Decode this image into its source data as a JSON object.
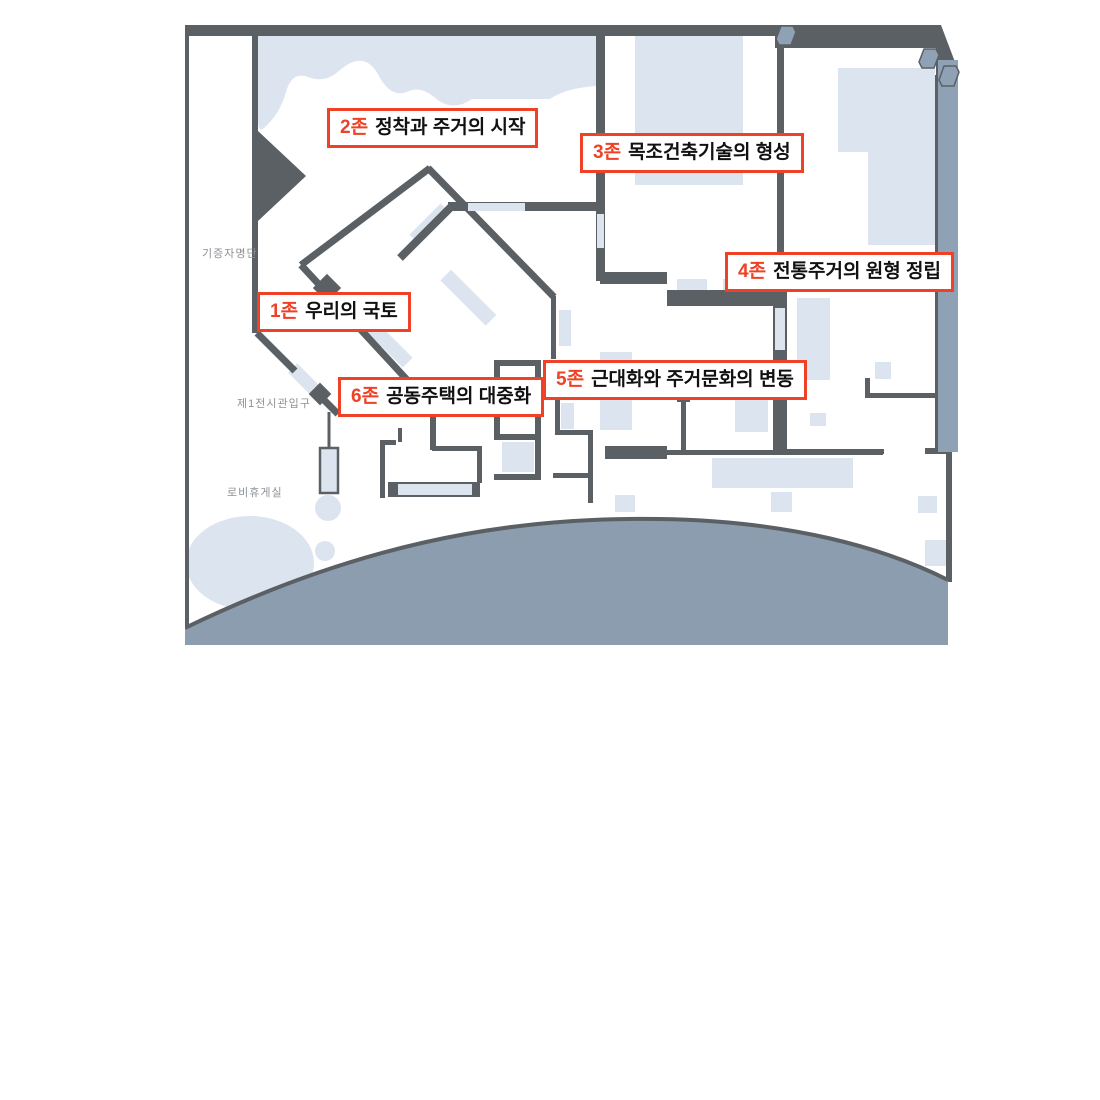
{
  "page": {
    "background": "#ffffff"
  },
  "floor_plan": {
    "area_labels": {
      "donor_list": "기증자명단",
      "hall1_entrance": "제1전시관입구",
      "lobby_lounge": "로비휴게실"
    },
    "zones": [
      {
        "num": "1존",
        "name": "우리의 국토"
      },
      {
        "num": "2존",
        "name": "정착과 주거의 시작"
      },
      {
        "num": "3존",
        "name": "목조건축기술의 형성"
      },
      {
        "num": "4존",
        "name": "전통주거의 원형 정립"
      },
      {
        "num": "5존",
        "name": "근대화와 주거문화의 변동"
      },
      {
        "num": "6존",
        "name": "공동주택의 대중화"
      }
    ],
    "colors": {
      "page_bg": "#ffffff",
      "wall": "#5B6065",
      "tint": "#DCE4EF",
      "dome": "#8C9DAF",
      "band": "#8FA1B5",
      "accent": "#EE4125",
      "muted_text": "#8D9298"
    }
  }
}
